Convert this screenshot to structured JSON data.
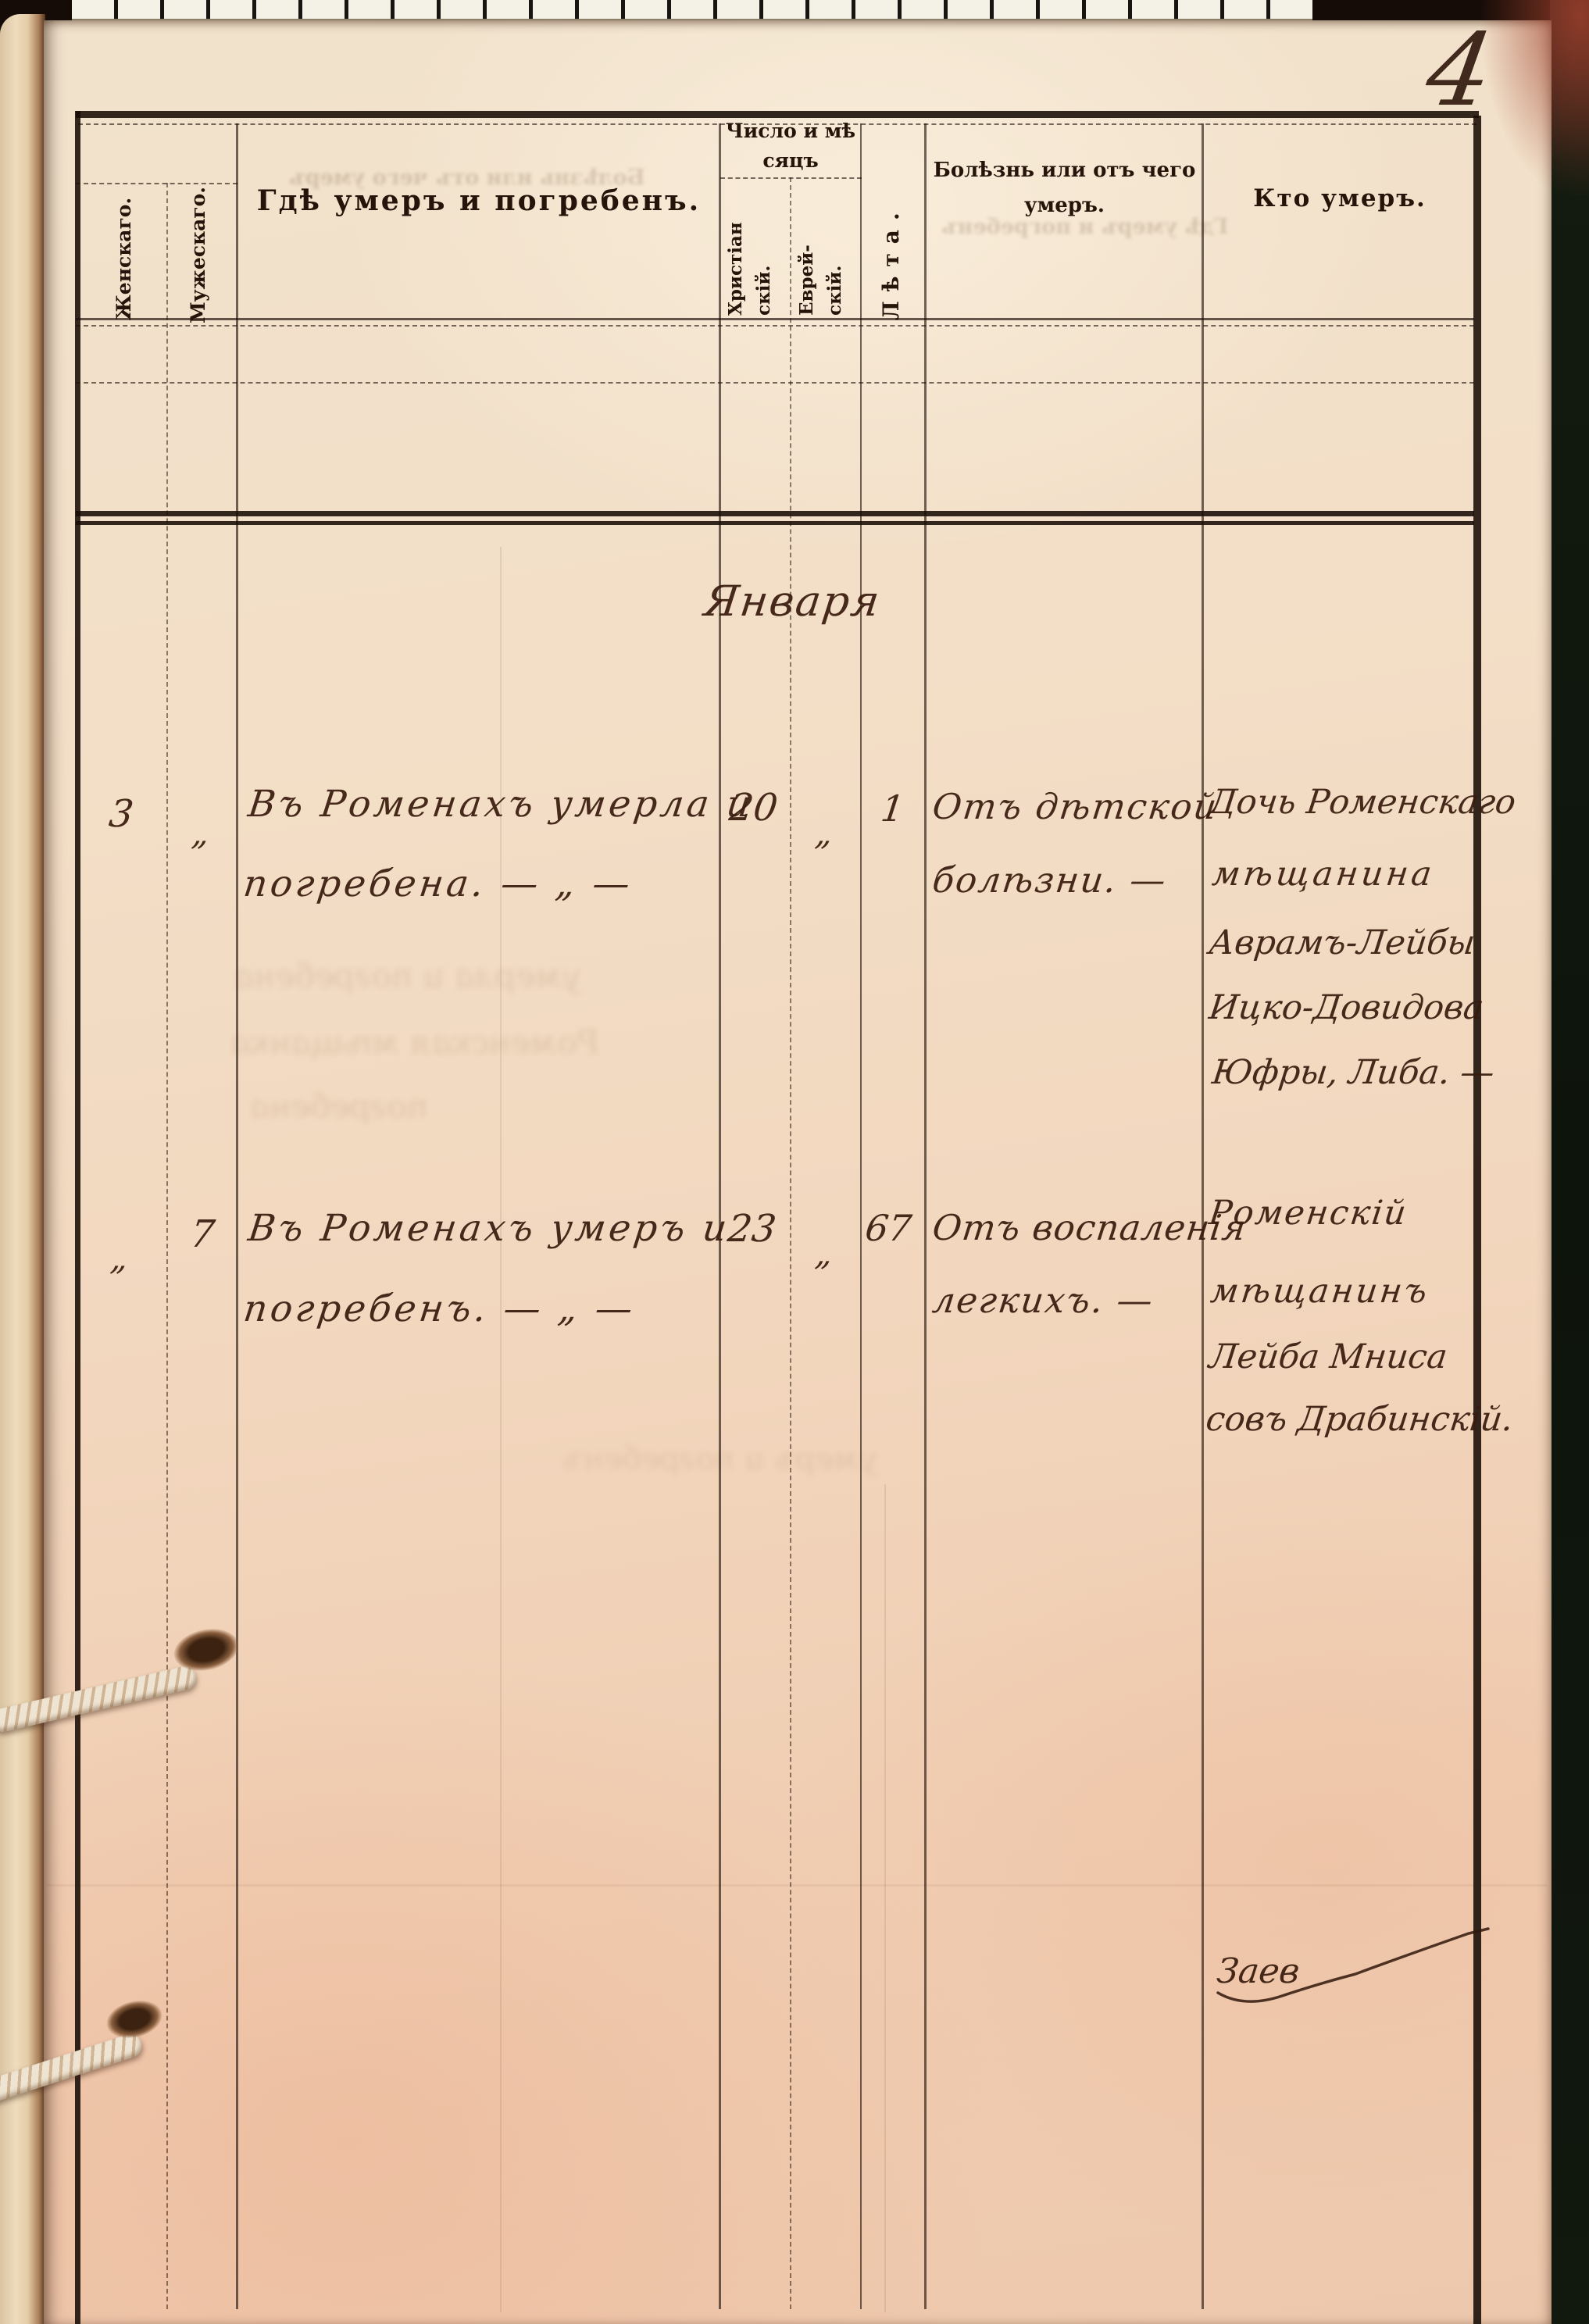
{
  "page": {
    "number": "4"
  },
  "colors": {
    "paper": "#f1d9c0",
    "paper_bottom": "#eec8ac",
    "ink_print": "#26140a",
    "ink_hand": "#3a1c0e",
    "cover": "#11180e",
    "cord": "#e9dcc8"
  },
  "table": {
    "col_female": "Женскаго.",
    "col_male": "Мужескаго.",
    "col_place": "Гдѣ умеръ и погребенъ.",
    "col_date_group": [
      "Число и мѣ",
      "сяцъ"
    ],
    "col_christian": [
      "Христіан",
      "скій."
    ],
    "col_jewish": [
      "Еврей-",
      "скій."
    ],
    "col_age": "Лѣта.",
    "col_cause": [
      "Болѣзнь или отъ чего",
      "умеръ."
    ],
    "col_who": "Кто умеръ."
  },
  "entries": {
    "month": "Января",
    "rows": [
      {
        "female": "3",
        "male": "„",
        "place": [
          "Въ Роменахъ умерла и",
          "погребена. — „ —"
        ],
        "date_christian": "20",
        "date_jewish": "„",
        "age": "1",
        "cause": [
          "Отъ дѣтской",
          "болѣзни. —"
        ],
        "who": [
          "Дочь Роменскаго",
          "мѣщанина",
          "Аврамъ-Лейбы",
          "Ицко-Довидова",
          "Юфры, Либа. —"
        ]
      },
      {
        "female": "„",
        "male": "7",
        "place": [
          "Въ Роменахъ умеръ и",
          "погребенъ. — „ —"
        ],
        "date_christian": "23",
        "date_jewish": "„",
        "age": "67",
        "cause": [
          "Отъ воспаленія",
          "легкихъ. —"
        ],
        "who": [
          "Роменскій",
          "мѣщанинъ",
          "Лейба Мниса",
          "совъ Драбинскій."
        ]
      }
    ],
    "signature": "Заев"
  },
  "ghosts": {
    "under_place_header": "Болѣзнь или отъ чего умеръ",
    "under_cause_header": "Гдѣ умеръ и погребенъ",
    "left_margin_1": "умерла и погребена",
    "left_margin_2": "Роменская мѣщанка",
    "left_margin_3": "погребена",
    "bottom_center": "умеръ и погребенъ"
  }
}
